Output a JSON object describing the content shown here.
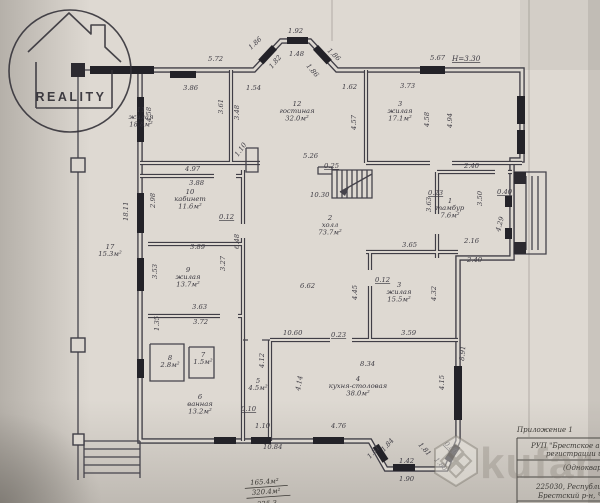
{
  "watermark": {
    "agency_label": "REALITY",
    "marketplace_label": "kufar"
  },
  "colors": {
    "paper": "#ded9d2",
    "ink": "#3d3b43",
    "window_fill": "#232228"
  },
  "plan": {
    "height_note": "Н=3.30",
    "rooms": [
      {
        "number": "11",
        "name": "жилая",
        "area": "18.8м²",
        "x": 141,
        "y": 112
      },
      {
        "number": "12",
        "name": "гостиная",
        "area": "32.0м²",
        "x": 297,
        "y": 106
      },
      {
        "number": "3",
        "name": "жилая",
        "area": "17.1м²",
        "x": 400,
        "y": 106
      },
      {
        "number": "10",
        "name": "кабинет",
        "area": "11.6м²",
        "x": 190,
        "y": 194
      },
      {
        "number": "2",
        "name": "холл",
        "area": "73.7м²",
        "x": 330,
        "y": 220
      },
      {
        "number": "9",
        "name": "жилая",
        "area": "13.7м²",
        "x": 188,
        "y": 272
      },
      {
        "number": "3",
        "name": "жилая",
        "area": "15.5м²",
        "x": 399,
        "y": 287
      },
      {
        "number": "1",
        "name": "тамбур",
        "area": "7.6м²",
        "x": 450,
        "y": 203
      },
      {
        "number": "17",
        "name": "",
        "area": "15.3м²",
        "x": 110,
        "y": 249
      },
      {
        "number": "8",
        "name": "",
        "area": "2.8м²",
        "x": 170,
        "y": 360
      },
      {
        "number": "7",
        "name": "",
        "area": "1.5м²",
        "x": 203,
        "y": 357
      },
      {
        "number": "5",
        "name": "",
        "area": "4.5м²",
        "x": 258,
        "y": 383
      },
      {
        "number": "6",
        "name": "ванная",
        "area": "13.2м²",
        "x": 200,
        "y": 399
      },
      {
        "number": "4",
        "name": "кухня-столовая",
        "area": "38.0м²",
        "x": 358,
        "y": 381
      }
    ],
    "dimensions": [
      {
        "t": "5.72",
        "x": 208,
        "y": 61
      },
      {
        "t": "1.86",
        "x": 251,
        "y": 50,
        "r": -43
      },
      {
        "t": "1.92",
        "x": 288,
        "y": 33
      },
      {
        "t": "1.48",
        "x": 289,
        "y": 56
      },
      {
        "t": "1.86",
        "x": 327,
        "y": 51,
        "r": 43
      },
      {
        "t": "1.82",
        "x": 272,
        "y": 69,
        "r": -50
      },
      {
        "t": "1.86",
        "x": 306,
        "y": 66,
        "r": 50
      },
      {
        "t": "5.67",
        "x": 430,
        "y": 60
      },
      {
        "t": "3.86",
        "x": 183,
        "y": 90
      },
      {
        "t": "1.54",
        "x": 246,
        "y": 90
      },
      {
        "t": "1.62",
        "x": 342,
        "y": 89
      },
      {
        "t": "3.73",
        "x": 400,
        "y": 88
      },
      {
        "t": "4.58",
        "x": 151,
        "y": 122,
        "r": -90
      },
      {
        "t": "3.61",
        "x": 223,
        "y": 114,
        "r": -90
      },
      {
        "t": "3.48",
        "x": 239,
        "y": 120,
        "r": -90
      },
      {
        "t": "4.57",
        "x": 356,
        "y": 130,
        "r": -90
      },
      {
        "t": "4.58",
        "x": 429,
        "y": 127,
        "r": -90
      },
      {
        "t": "4.94",
        "x": 452,
        "y": 128,
        "r": -90
      },
      {
        "t": "1.10",
        "x": 238,
        "y": 157,
        "r": -55
      },
      {
        "t": "5.26",
        "x": 303,
        "y": 158
      },
      {
        "t": "0.25",
        "x": 324,
        "y": 168,
        "u": 1
      },
      {
        "t": "4.97",
        "x": 185,
        "y": 171
      },
      {
        "t": "3.88",
        "x": 189,
        "y": 185
      },
      {
        "t": "10.30",
        "x": 310,
        "y": 197
      },
      {
        "t": "2.98",
        "x": 155,
        "y": 208,
        "r": -90
      },
      {
        "t": "0.12",
        "x": 219,
        "y": 219,
        "u": 1
      },
      {
        "t": "6.48",
        "x": 239,
        "y": 249,
        "r": -90
      },
      {
        "t": "3.89",
        "x": 190,
        "y": 249
      },
      {
        "t": "3.27",
        "x": 225,
        "y": 271,
        "r": -90
      },
      {
        "t": "3.53",
        "x": 157,
        "y": 279,
        "r": -90
      },
      {
        "t": "18.11",
        "x": 128,
        "y": 221,
        "r": -90
      },
      {
        "t": "3.63",
        "x": 192,
        "y": 309
      },
      {
        "t": "3.72",
        "x": 193,
        "y": 324
      },
      {
        "t": "1.35",
        "x": 159,
        "y": 331,
        "r": -90
      },
      {
        "t": "6.62",
        "x": 300,
        "y": 288
      },
      {
        "t": "4.45",
        "x": 357,
        "y": 300,
        "r": -90
      },
      {
        "t": "0.12",
        "x": 375,
        "y": 282,
        "u": 1
      },
      {
        "t": "3.65",
        "x": 402,
        "y": 247
      },
      {
        "t": "2.16",
        "x": 464,
        "y": 243
      },
      {
        "t": "2.40",
        "x": 464,
        "y": 168
      },
      {
        "t": "2.40",
        "x": 467,
        "y": 262
      },
      {
        "t": "0.23",
        "x": 428,
        "y": 195,
        "u": 1
      },
      {
        "t": "3.63",
        "x": 431,
        "y": 212,
        "r": -90
      },
      {
        "t": "0.40",
        "x": 497,
        "y": 194,
        "u": 1
      },
      {
        "t": "3.50",
        "x": 482,
        "y": 206,
        "r": -90
      },
      {
        "t": "4.29",
        "x": 500,
        "y": 232,
        "r": -75
      },
      {
        "t": "4.32",
        "x": 436,
        "y": 301,
        "r": -90
      },
      {
        "t": "3.59",
        "x": 401,
        "y": 335
      },
      {
        "t": "10.60",
        "x": 283,
        "y": 335
      },
      {
        "t": "0.23",
        "x": 331,
        "y": 337,
        "u": 1
      },
      {
        "t": "8.34",
        "x": 360,
        "y": 366
      },
      {
        "t": "8.91",
        "x": 464,
        "y": 361,
        "r": -85
      },
      {
        "t": "4.15",
        "x": 444,
        "y": 390,
        "r": -90
      },
      {
        "t": "4.14",
        "x": 300,
        "y": 391,
        "r": -80
      },
      {
        "t": "4.12",
        "x": 264,
        "y": 368,
        "r": -90
      },
      {
        "t": "0.10",
        "x": 241,
        "y": 411,
        "u": 1
      },
      {
        "t": "4.76",
        "x": 331,
        "y": 428
      },
      {
        "t": "1.10",
        "x": 255,
        "y": 428
      },
      {
        "t": "10.84",
        "x": 263,
        "y": 449
      },
      {
        "t": "1.84",
        "x": 384,
        "y": 452,
        "r": -48
      },
      {
        "t": "1.81",
        "x": 370,
        "y": 459,
        "r": -48
      },
      {
        "t": "1.42",
        "x": 399,
        "y": 463
      },
      {
        "t": "1.90",
        "x": 399,
        "y": 481
      },
      {
        "t": "1.81",
        "x": 418,
        "y": 445,
        "r": 48
      },
      {
        "t": "1.80",
        "x": 434,
        "y": 460,
        "r": 48
      },
      {
        "t": "0.80",
        "x": 444,
        "y": 444,
        "r": 45,
        "u": 1
      }
    ],
    "area_summary": {
      "line1": "165.4м²",
      "line2": "320.4м²",
      "line3": "325.3"
    }
  },
  "title_block": {
    "annex_label": "Приложение 1",
    "rows": [
      "РУП \"Брестское аген",
      "регистрации и з",
      "(Однокварт",
      "225030, Республика",
      "Брестский р-н, Чер"
    ]
  }
}
